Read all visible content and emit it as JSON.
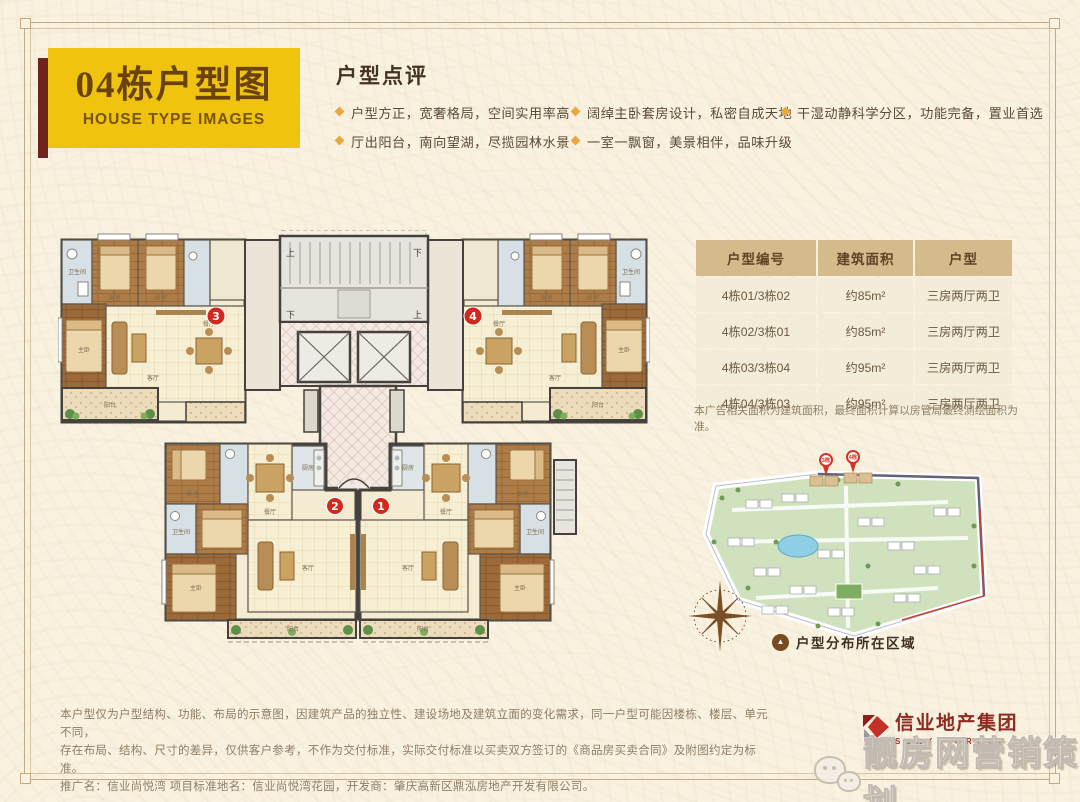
{
  "page": {
    "background": "#f9f2e1",
    "frame_color": "#c9b28c"
  },
  "header": {
    "title": "04栋户型图",
    "subtitle": "HOUSE TYPE IMAGES",
    "box_color": "#efc30e",
    "accent_color": "#6e241c",
    "review": {
      "heading": "户型点评",
      "bullet_color": "#eaa93e",
      "cols": [
        [
          "户型方正，宽奢格局，空间实用率高",
          "厅出阳台，南向望湖，尽揽园林水景"
        ],
        [
          "阔绰主卧套房设计，私密自成天地",
          "一室一飘窗，美景相伴，品味升级"
        ],
        [
          "干湿动静科学分区，功能完备，置业首选"
        ]
      ]
    }
  },
  "table": {
    "headers": [
      "户型编号",
      "建筑面积",
      "户型"
    ],
    "rows": [
      [
        "4栋01/3栋02",
        "约85m²",
        "三房两厅两卫"
      ],
      [
        "4栋02/3栋01",
        "约85m²",
        "三房两厅两卫"
      ],
      [
        "4栋03/3栋04",
        "约95m²",
        "三房两厅两卫"
      ],
      [
        "4栋04/3栋03",
        "约95m²",
        "三房两厅两卫"
      ]
    ],
    "note": "本广告相关面积为建筑面积，最终面积计算以房管局最终测绘面积为准。"
  },
  "floorplans": {
    "marker_color": "#d3281e",
    "units": {
      "u1": "1",
      "u2": "2",
      "u3": "3",
      "u4": "4"
    },
    "stairs": {
      "up": "上",
      "down": "下"
    },
    "rooms": {
      "master": "主卧",
      "bedroom": "卧室",
      "living": "客厅",
      "dining": "餐厅",
      "kitchen": "厨房",
      "bath": "卫生间",
      "balcony": "阳台"
    }
  },
  "sitemap": {
    "pins": [
      "3栋",
      "4栋"
    ],
    "caption": "户型分布所在区域",
    "caption_icon": "▲"
  },
  "disclaimer": {
    "line1": "本户型仅为户型结构、功能、布局的示意图，因建筑产品的独立性、建设场地及建筑立面的变化需求，同一户型可能因楼栋、楼层、单元不同，",
    "line2": "存在布局、结构、尺寸的差异，仅供客户参考，不作为交付标准，实际交付标准以买卖双方签订的《商品房买卖合同》及附图约定为标准。",
    "line3": "推广名：信业尚悦湾 项目标准地名：信业尚悦湾花园，开发商：肇庆高新区鼎泓房地产开发有限公司。"
  },
  "branding": {
    "logo_name": "信业地产集团",
    "logo_sub": "SUNYE GROUP",
    "logo_color": "#8e2a1f",
    "watermark": "靓房网营销策划"
  }
}
